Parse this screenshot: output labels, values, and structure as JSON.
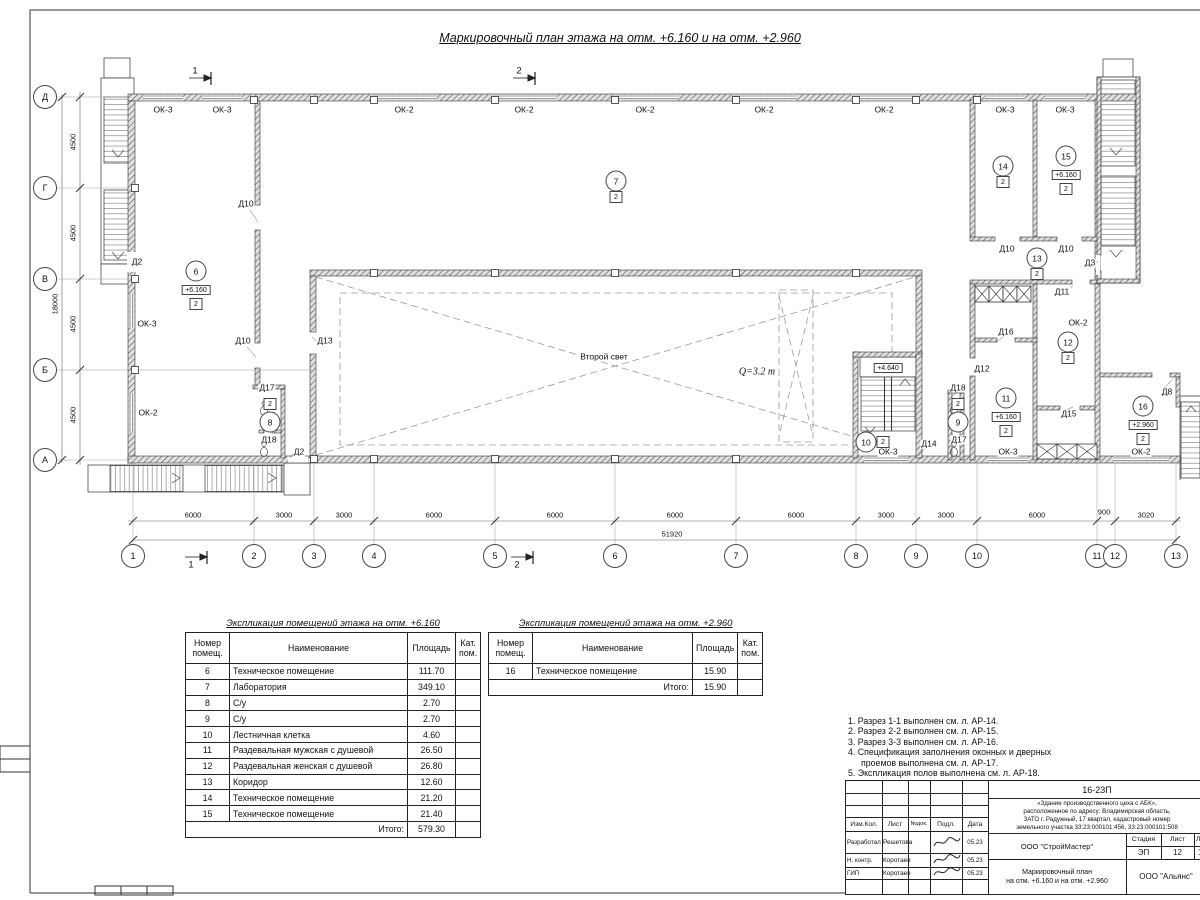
{
  "sheet": {
    "plan_title": "Маркировочный план этажа на отм. +6.160 и на отм. +2.960"
  },
  "plan": {
    "axes_rows": [
      {
        "label": "Д",
        "y": 97
      },
      {
        "label": "Г",
        "y": 188
      },
      {
        "label": "В",
        "y": 279
      },
      {
        "label": "Б",
        "y": 370
      },
      {
        "label": "А",
        "y": 460
      }
    ],
    "axes_cols": [
      {
        "label": "1",
        "x": 133
      },
      {
        "label": "2",
        "x": 254
      },
      {
        "label": "3",
        "x": 314
      },
      {
        "label": "4",
        "x": 374
      },
      {
        "label": "5",
        "x": 495
      },
      {
        "label": "6",
        "x": 615
      },
      {
        "label": "7",
        "x": 736
      },
      {
        "label": "8",
        "x": 856
      },
      {
        "label": "9",
        "x": 916
      },
      {
        "label": "10",
        "x": 977
      },
      {
        "label": "11",
        "x": 1097
      },
      {
        "label": "12",
        "x": 1115
      },
      {
        "label": "13",
        "x": 1176
      }
    ],
    "dims_left": [
      {
        "text": "4500",
        "y": 142
      },
      {
        "text": "4500",
        "y": 233
      },
      {
        "text": "4500",
        "y": 324
      },
      {
        "text": "4500",
        "y": 415
      }
    ],
    "dim_left_total": "18000",
    "dims_bottom": [
      {
        "text": "6000",
        "x": 193,
        "y": 515
      },
      {
        "text": "3000",
        "x": 284,
        "y": 515
      },
      {
        "text": "3000",
        "x": 344,
        "y": 515
      },
      {
        "text": "6000",
        "x": 434,
        "y": 515
      },
      {
        "text": "6000",
        "x": 555,
        "y": 515
      },
      {
        "text": "6000",
        "x": 675,
        "y": 515
      },
      {
        "text": "6000",
        "x": 796,
        "y": 515
      },
      {
        "text": "3000",
        "x": 886,
        "y": 515
      },
      {
        "text": "3000",
        "x": 946,
        "y": 515
      },
      {
        "text": "6000",
        "x": 1037,
        "y": 515
      },
      {
        "text": "900",
        "x": 1104,
        "y": 512
      },
      {
        "text": "3020",
        "x": 1146,
        "y": 515
      }
    ],
    "dim_bottom_total": "51920",
    "section_marks": [
      {
        "label": "1",
        "x": 195,
        "y": 71
      },
      {
        "label": "2",
        "x": 519,
        "y": 71
      },
      {
        "label": "1",
        "x": 191,
        "y": 565
      },
      {
        "label": "2",
        "x": 517,
        "y": 565
      }
    ],
    "window_labels": [
      {
        "t": "ОК-3",
        "x": 163,
        "y": 110
      },
      {
        "t": "ОК-3",
        "x": 222,
        "y": 110
      },
      {
        "t": "ОК-2",
        "x": 404,
        "y": 110
      },
      {
        "t": "ОК-2",
        "x": 524,
        "y": 110
      },
      {
        "t": "ОК-2",
        "x": 645,
        "y": 110
      },
      {
        "t": "ОК-2",
        "x": 764,
        "y": 110
      },
      {
        "t": "ОК-2",
        "x": 884,
        "y": 110
      },
      {
        "t": "ОК-3",
        "x": 1005,
        "y": 110
      },
      {
        "t": "ОК-3",
        "x": 1065,
        "y": 110
      },
      {
        "t": "ОК-3",
        "x": 147,
        "y": 324
      },
      {
        "t": "ОК-2",
        "x": 148,
        "y": 413
      },
      {
        "t": "ОК-3",
        "x": 888,
        "y": 452
      },
      {
        "t": "ОК-3",
        "x": 1008,
        "y": 452
      },
      {
        "t": "ОК-2",
        "x": 1141,
        "y": 452
      },
      {
        "t": "ОК-2",
        "x": 1078,
        "y": 323
      }
    ],
    "door_labels": [
      {
        "t": "Д2",
        "x": 137,
        "y": 262
      },
      {
        "t": "Д10",
        "x": 246,
        "y": 204
      },
      {
        "t": "Д10",
        "x": 243,
        "y": 341
      },
      {
        "t": "Д13",
        "x": 325,
        "y": 341
      },
      {
        "t": "Д17",
        "x": 267,
        "y": 388
      },
      {
        "t": "Д18",
        "x": 269,
        "y": 440
      },
      {
        "t": "Д2",
        "x": 299,
        "y": 452
      },
      {
        "t": "Д14",
        "x": 929,
        "y": 444
      },
      {
        "t": "Д18",
        "x": 958,
        "y": 388
      },
      {
        "t": "Д17",
        "x": 959,
        "y": 440
      },
      {
        "t": "Д12",
        "x": 982,
        "y": 369
      },
      {
        "t": "Д16",
        "x": 1006,
        "y": 332
      },
      {
        "t": "Д11",
        "x": 1062,
        "y": 292
      },
      {
        "t": "Д15",
        "x": 1069,
        "y": 414
      },
      {
        "t": "Д10",
        "x": 1007,
        "y": 249
      },
      {
        "t": "Д10",
        "x": 1066,
        "y": 249
      },
      {
        "t": "Д3",
        "x": 1090,
        "y": 263
      },
      {
        "t": "Д8",
        "x": 1167,
        "y": 392
      }
    ],
    "rooms": [
      {
        "num": "6",
        "x": 196,
        "y": 271,
        "elev": "+6.160",
        "cat": "2"
      },
      {
        "num": "7",
        "x": 616,
        "y": 181,
        "cat": "2"
      },
      {
        "num": "8",
        "x": 270,
        "y": 422,
        "cat": "2",
        "cat_pos": "above"
      },
      {
        "num": "9",
        "x": 958,
        "y": 422,
        "cat": "2",
        "cat_pos": "above"
      },
      {
        "num": "10",
        "x": 866,
        "y": 442,
        "cat": "2",
        "cat_pos": "side"
      },
      {
        "num": "11",
        "x": 1006,
        "y": 398,
        "elev": "+6.160",
        "cat": "2"
      },
      {
        "num": "12",
        "x": 1068,
        "y": 342,
        "cat": "2"
      },
      {
        "num": "13",
        "x": 1037,
        "y": 258,
        "cat": "2"
      },
      {
        "num": "14",
        "x": 1003,
        "y": 166,
        "cat": "2"
      },
      {
        "num": "15",
        "x": 1066,
        "y": 156,
        "elev": "+6.160",
        "cat": "2"
      },
      {
        "num": "16",
        "x": 1143,
        "y": 406,
        "elev": "+2.960",
        "cat": "2"
      }
    ],
    "annotations": [
      {
        "text": "Второй свет",
        "x": 604,
        "y": 357
      },
      {
        "text": "Q=3.2 т",
        "x": 757,
        "y": 372,
        "style": "italic"
      },
      {
        "text": "+4.640",
        "x": 888,
        "y": 368,
        "boxed": true
      }
    ]
  },
  "tables": [
    {
      "title": "Экспликация помещений этажа на отм. +6.160",
      "headers": [
        "Номер\nпомещ.",
        "Наименование",
        "Площадь",
        "Кат.\nпом."
      ],
      "rows": [
        [
          "6",
          "Техническое помещение",
          "111.70"
        ],
        [
          "7",
          "Лаборатория",
          "349.10"
        ],
        [
          "8",
          "С/у",
          "2.70"
        ],
        [
          "9",
          "С/у",
          "2.70"
        ],
        [
          "10",
          "Лестничная клетка",
          "4.60"
        ],
        [
          "11",
          "Раздевальная мужская с душевой",
          "26.50"
        ],
        [
          "12",
          "Раздевальная женская с душевой",
          "26.80"
        ],
        [
          "13",
          "Коридор",
          "12.60"
        ],
        [
          "14",
          "Техническое помещение",
          "21.20"
        ],
        [
          "15",
          "Техническое помещение",
          "21.40"
        ]
      ],
      "total_label": "Итого:",
      "total": "579.30"
    },
    {
      "title": "Экспликация помещений этажа на отм. +2.960",
      "headers": [
        "Номер\nпомещ.",
        "Наименование",
        "Площадь",
        "Кат.\nпом."
      ],
      "rows": [
        [
          "16",
          "Техническое помещение",
          "15.90"
        ]
      ],
      "total_label": "Итого:",
      "total": "15.90"
    }
  ],
  "notes": [
    {
      "text": "1. Разрез 1-1 выполнен см. л. АР-14."
    },
    {
      "text": "2. Разрез 2-2 выполнен см. л. АР-15."
    },
    {
      "text": "3. Разрез 3-3 выполнен см. л. АР-16."
    },
    {
      "text": "4. Спецификация заполнения оконных и дверных"
    },
    {
      "text": "проемов выполнена см. л. АР-17.",
      "indent": true
    },
    {
      "text": "5. Экспликация полов выполнена см. л. АР-18."
    }
  ],
  "titleblock": {
    "doc_number": "16-23П",
    "object_description": "«Здание производственного цеха с АБК»,\nрасположенное по адресу: Владимирская область,\nЗАТО г. Радужный, 17 квартал, кадастровый номер\nземельного участка 33:23:000101:456, 33:23:000101:508",
    "header_cols": [
      "Изм.Кол.",
      "Лист",
      "№док.",
      "Подл.",
      "Дата"
    ],
    "sign_rows": [
      {
        "role": "Разработал",
        "name": "Решетова",
        "date": "05.23"
      },
      {
        "role": "Н. контр.",
        "name": "Коротаев",
        "date": "05.23"
      },
      {
        "role": "ГИП",
        "name": "Коротаев",
        "date": "05.23"
      }
    ],
    "org": "ООО \"СтройМастер\"",
    "stage_label": "Стадия",
    "sheet_label": "Лист",
    "sheets_label": "Листов",
    "stage": "ЭП",
    "sheet_num": "12",
    "sheets_num": "1",
    "drawing_title_line1": "Маркировочный план",
    "drawing_title_line2": "на отм. +6.160 и на отм. +2.960",
    "org2": "ООО \"Альянс\""
  }
}
